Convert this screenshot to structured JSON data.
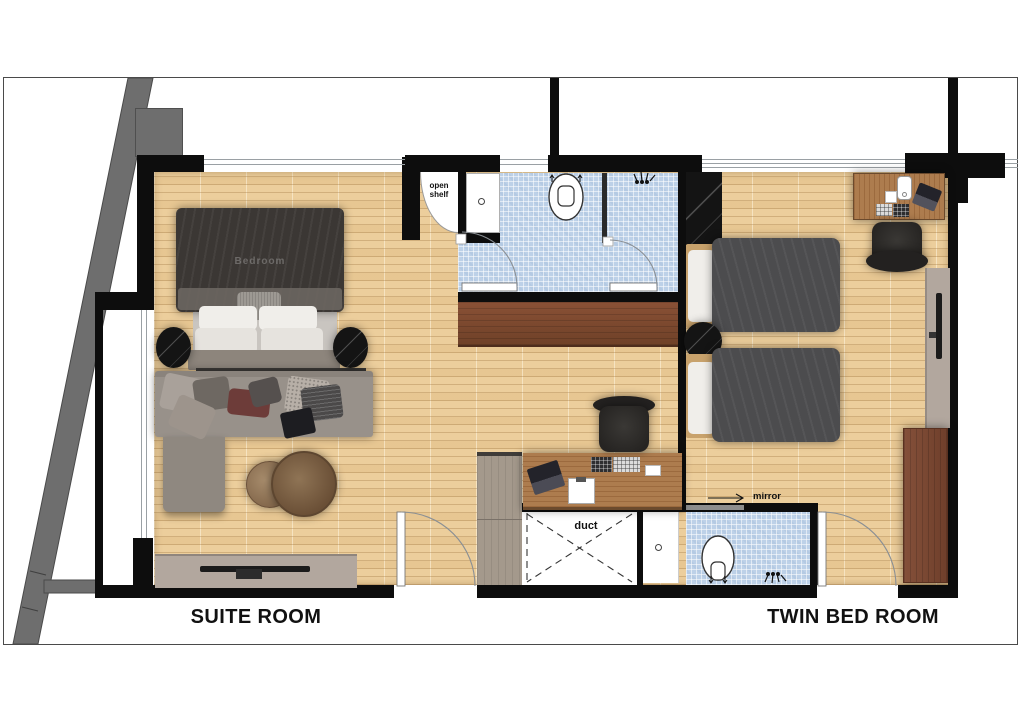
{
  "labels": {
    "suite_room": "SUITE ROOM",
    "twin_bed_room": "TWIN BED ROOM",
    "open_shelf": "open shelf",
    "duct": "duct",
    "mirror": "mirror",
    "bed_watermark": "Bedroom"
  },
  "icons": {
    "toilet": "toilet-icon",
    "shower": "shower-head-icon",
    "mirror_arrow": "arrow-right-icon",
    "door_swing": "door-swing-arc"
  },
  "colors": {
    "wall": "#0d0d0d",
    "border": "#4a4a4a",
    "floor": "#ecce9c",
    "tile": "#bdd1e8",
    "structure": "#6e6e6e",
    "window_line": "#9aa0a4",
    "cabinet_wood": "#7d4b33",
    "desk_wood": "#ad7c4e",
    "wardrobe_wood": "#7b4834",
    "console": "#b2a79e",
    "sofa": "#98918a",
    "duvet": "#4c4c4e",
    "blanket": "#3b3734",
    "chair": "#32302e",
    "marble": "#141414",
    "pillow": "#f0eeea",
    "bedframe": "#c8a26c",
    "arc": "#8a8f94"
  }
}
